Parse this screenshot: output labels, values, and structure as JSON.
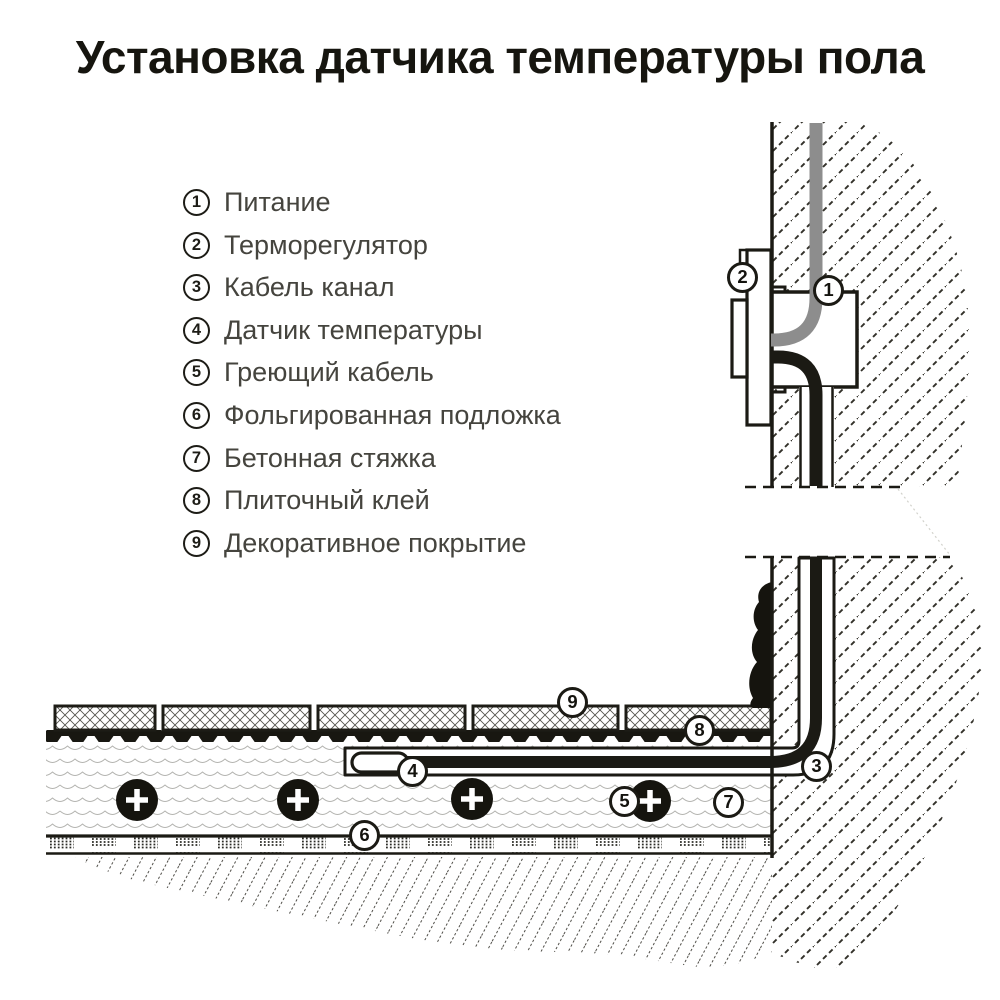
{
  "title": "Установка датчика температуры пола",
  "legend": {
    "items": [
      {
        "num": "1",
        "label": "Питание"
      },
      {
        "num": "2",
        "label": "Терморегулятор"
      },
      {
        "num": "3",
        "label": "Кабель канал"
      },
      {
        "num": "4",
        "label": "Датчик температуры"
      },
      {
        "num": "5",
        "label": "Греющий кабель"
      },
      {
        "num": "6",
        "label": "Фольгированная подложка"
      },
      {
        "num": "7",
        "label": "Бетонная стяжка"
      },
      {
        "num": "8",
        "label": "Плиточный клей"
      },
      {
        "num": "9",
        "label": "Декоративное покрытие"
      }
    ]
  },
  "callouts": [
    "1",
    "2",
    "3",
    "4",
    "5",
    "6",
    "7",
    "8",
    "9"
  ],
  "colors": {
    "ink": "#1b1a14",
    "power_cable_gray": "#8d8d8d",
    "background": "#ffffff"
  }
}
